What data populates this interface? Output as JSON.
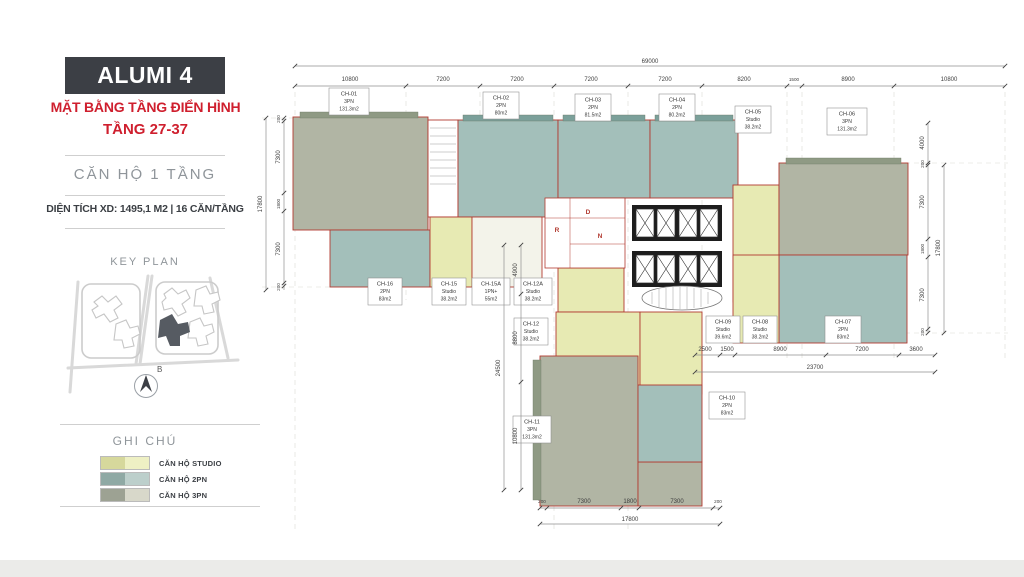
{
  "sidebar": {
    "project_title": "ALUMI 4",
    "subtitle_line1": "MẶT BẰNG TẦNG ĐIỂN HÌNH",
    "subtitle_line2": "TẦNG 27-37",
    "unit_type_line": "CĂN HỘ 1 TẦNG",
    "info_line": "DIỆN TÍCH XD: 1495,1 M2  |  16 CĂN/TẦNG",
    "keyplan_title": "KEY PLAN",
    "compass_label": "B",
    "legend": {
      "title": "GHI CHÚ",
      "items": [
        {
          "label": "CĂN HỘ STUDIO",
          "color_dark": "#d6d89c",
          "color_light": "#eef0c4"
        },
        {
          "label": "CĂN HỘ 2PN",
          "color_dark": "#8fa9a4",
          "color_light": "#bccfcb"
        },
        {
          "label": "CĂN HỘ 3PN",
          "color_dark": "#9da293",
          "color_light": "#d8d8ca"
        }
      ]
    }
  },
  "plan": {
    "units": [
      {
        "id": "CH-01",
        "type": "3PN",
        "area": "131.3m2"
      },
      {
        "id": "CH-02",
        "type": "2PN",
        "area": "80m2"
      },
      {
        "id": "CH-03",
        "type": "2PN",
        "area": "81.5m2"
      },
      {
        "id": "CH-04",
        "type": "2PN",
        "area": "80.2m2"
      },
      {
        "id": "CH-05",
        "type": "Studio",
        "area": "38.2m2"
      },
      {
        "id": "CH-06",
        "type": "3PN",
        "area": "131.3m2"
      },
      {
        "id": "CH-07",
        "type": "2PN",
        "area": "83m2"
      },
      {
        "id": "CH-08",
        "type": "Studio",
        "area": "38.2m2"
      },
      {
        "id": "CH-09",
        "type": "Studio",
        "area": "39.6m2"
      },
      {
        "id": "CH-10",
        "type": "2PN",
        "area": "83m2"
      },
      {
        "id": "CH-11",
        "type": "3PN",
        "area": "131.3m2"
      },
      {
        "id": "CH-12",
        "type": "Studio",
        "area": "38.2m2"
      },
      {
        "id": "CH-12A",
        "type": "Studio",
        "area": "38.2m2"
      },
      {
        "id": "CH-15",
        "type": "Studio",
        "area": "38.2m2"
      },
      {
        "id": "CH-15A",
        "type": "1PN+",
        "area": "55m2"
      },
      {
        "id": "CH-16",
        "type": "2PN",
        "area": "83m2"
      }
    ],
    "core_labels": {
      "r": "R",
      "d": "D",
      "n": "N"
    },
    "dims": {
      "top_total": "69000",
      "top": [
        "10800",
        "7200",
        "7200",
        "7200",
        "7200",
        "8200",
        "1500",
        "8900",
        "10800"
      ],
      "left_total": "17800",
      "left": [
        "200",
        "7300",
        "1800",
        "7300",
        "200"
      ],
      "left_lower_total": "24500",
      "left_lower": [
        "4900",
        "8800",
        "10800"
      ],
      "right_offset": "4000",
      "right_total": "17800",
      "right": [
        "200",
        "7300",
        "1800",
        "7300",
        "200"
      ],
      "bottom_total": "17800",
      "bottom": [
        "200",
        "7300",
        "1800",
        "7300",
        "200"
      ],
      "mid_total": "23700",
      "mid": [
        "2500",
        "1500",
        "8900",
        "7200",
        "3600"
      ]
    }
  }
}
